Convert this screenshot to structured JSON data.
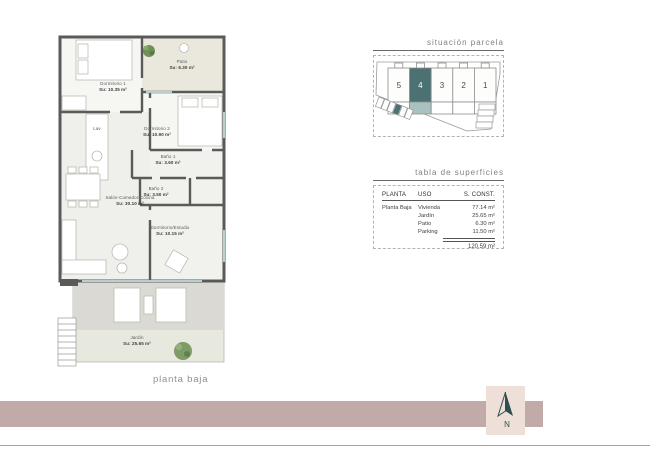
{
  "page": {
    "caption": "planta baja"
  },
  "floorplan": {
    "rooms": {
      "dormitorio1": {
        "name": "Dormitorio 1",
        "area": "Su: 10.35 m²"
      },
      "patio": {
        "name": "Patio",
        "area": "Su: 6.30 m²"
      },
      "dormitorio2": {
        "name": "Dormitorio 2",
        "area": "Su: 10.90 m²"
      },
      "bano1": {
        "name": "Baño 1",
        "area": "Su: 3.60 m²"
      },
      "bano2": {
        "name": "Baño 2",
        "area": "Su: 3.50 m²"
      },
      "lav": {
        "name": "Lav"
      },
      "salon": {
        "name": "Salón-Comedor-Cocina",
        "area": "Su: 30.10 m²"
      },
      "estudio": {
        "name": "Dormitorio/Estudio",
        "area": "Su: 10.15 m²"
      },
      "jardin": {
        "name": "Jardín",
        "area": "Su: 25.65 m²"
      }
    }
  },
  "parcel": {
    "title": "situación parcela",
    "units": [
      "5",
      "4",
      "3",
      "2",
      "1"
    ],
    "highlighted_unit": "4"
  },
  "surfaces": {
    "title": "tabla de superficies",
    "headers": {
      "planta": "PLANTA",
      "uso": "USO",
      "sconst": "S. CONST."
    },
    "planta_label": "Planta Baja",
    "rows": [
      {
        "uso": "Vivienda",
        "sconst": "77.14 m²"
      },
      {
        "uso": "Jardín",
        "sconst": "25.65 m²"
      },
      {
        "uso": "Patio",
        "sconst": "6.30 m²"
      },
      {
        "uso": "Parking",
        "sconst": "11.50 m²"
      }
    ],
    "total": "120.59 m²"
  },
  "compass": {
    "label": "N"
  },
  "colors": {
    "band": "#c1aaa7",
    "compass_bg": "#eee0d9",
    "accent_teal_dark": "#4b7173",
    "accent_teal_light": "#a9c2bf",
    "wall": "#5a5a58",
    "terrace": "#dbd9d3",
    "garden": "#e7e9de",
    "patio_floor": "#eae8dd",
    "glass": "#b9cfcd"
  }
}
